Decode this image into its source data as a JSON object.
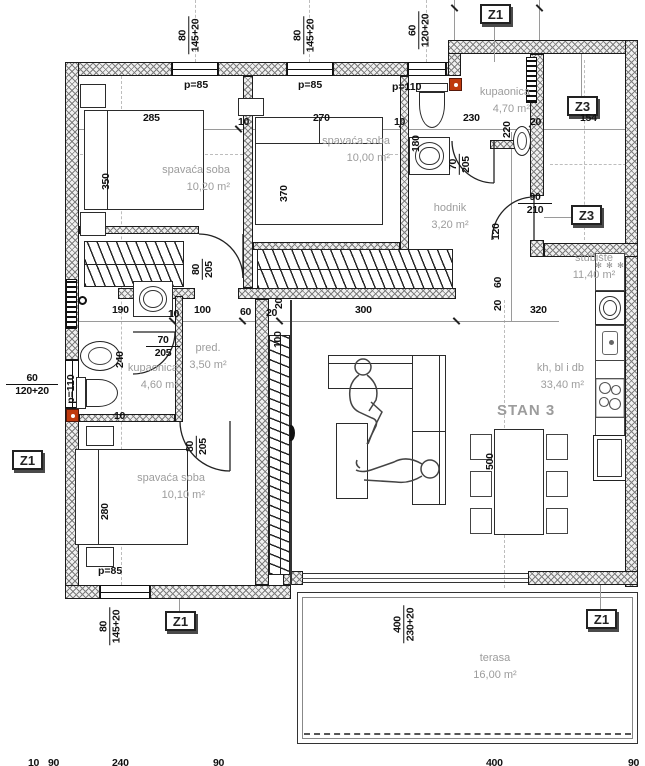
{
  "title": "STAN 3",
  "colors": {
    "wall_hatch": "#7e7e7e",
    "label_gray": "#9c9c9c",
    "dim_black": "#111111",
    "marker_red": "#bf3a0e"
  },
  "rooms": [
    {
      "name": "spavaća soba",
      "area": "10,20 m²"
    },
    {
      "name": "spavaća soba",
      "area": "10,00 m²"
    },
    {
      "name": "kupaonica",
      "area": "4,70 m²"
    },
    {
      "name": "stubište",
      "area": "11,40 m²"
    },
    {
      "name": "hodnik",
      "area": "3,20 m²"
    },
    {
      "name": "pred.",
      "area": "3,50 m²"
    },
    {
      "name": "kupaonica",
      "area": "4,60 m²"
    },
    {
      "name": "spavaća soba",
      "area": "10,10 m²"
    },
    {
      "name": "kh, bl i db",
      "area": "33,40 m²"
    },
    {
      "name": "terasa",
      "area": "16,00 m²"
    }
  ],
  "markers": [
    "Z1",
    "Z3",
    "Z3",
    "Z1",
    "Z1",
    "Z1"
  ],
  "dims": [
    "285",
    "10",
    "270",
    "10",
    "230",
    "20",
    "154",
    "350",
    "370",
    "180",
    "220",
    "190",
    "10",
    "100",
    "60",
    "20",
    "300",
    "320",
    "100",
    "20",
    "240",
    "280",
    "500",
    "120",
    "60",
    "20",
    "10",
    "10",
    "90",
    "240",
    "90",
    "400",
    "90"
  ],
  "fracs": [
    {
      "t": "80",
      "b": "145+20"
    },
    {
      "t": "80",
      "b": "145+20"
    },
    {
      "t": "60",
      "b": "120+20"
    },
    {
      "t": "60",
      "b": "120+20"
    },
    {
      "t": "70",
      "b": "205"
    },
    {
      "t": "90",
      "b": "210"
    },
    {
      "t": "70",
      "b": "205"
    },
    {
      "t": "80",
      "b": "205"
    },
    {
      "t": "80",
      "b": "205"
    },
    {
      "t": "80",
      "b": "145+20"
    },
    {
      "t": "400",
      "b": "230+20"
    }
  ],
  "plabels": [
    "p=85",
    "p=85",
    "p=110",
    "p=110",
    "p=85"
  ],
  "freezer_marks": "✻ ✻ ✻"
}
